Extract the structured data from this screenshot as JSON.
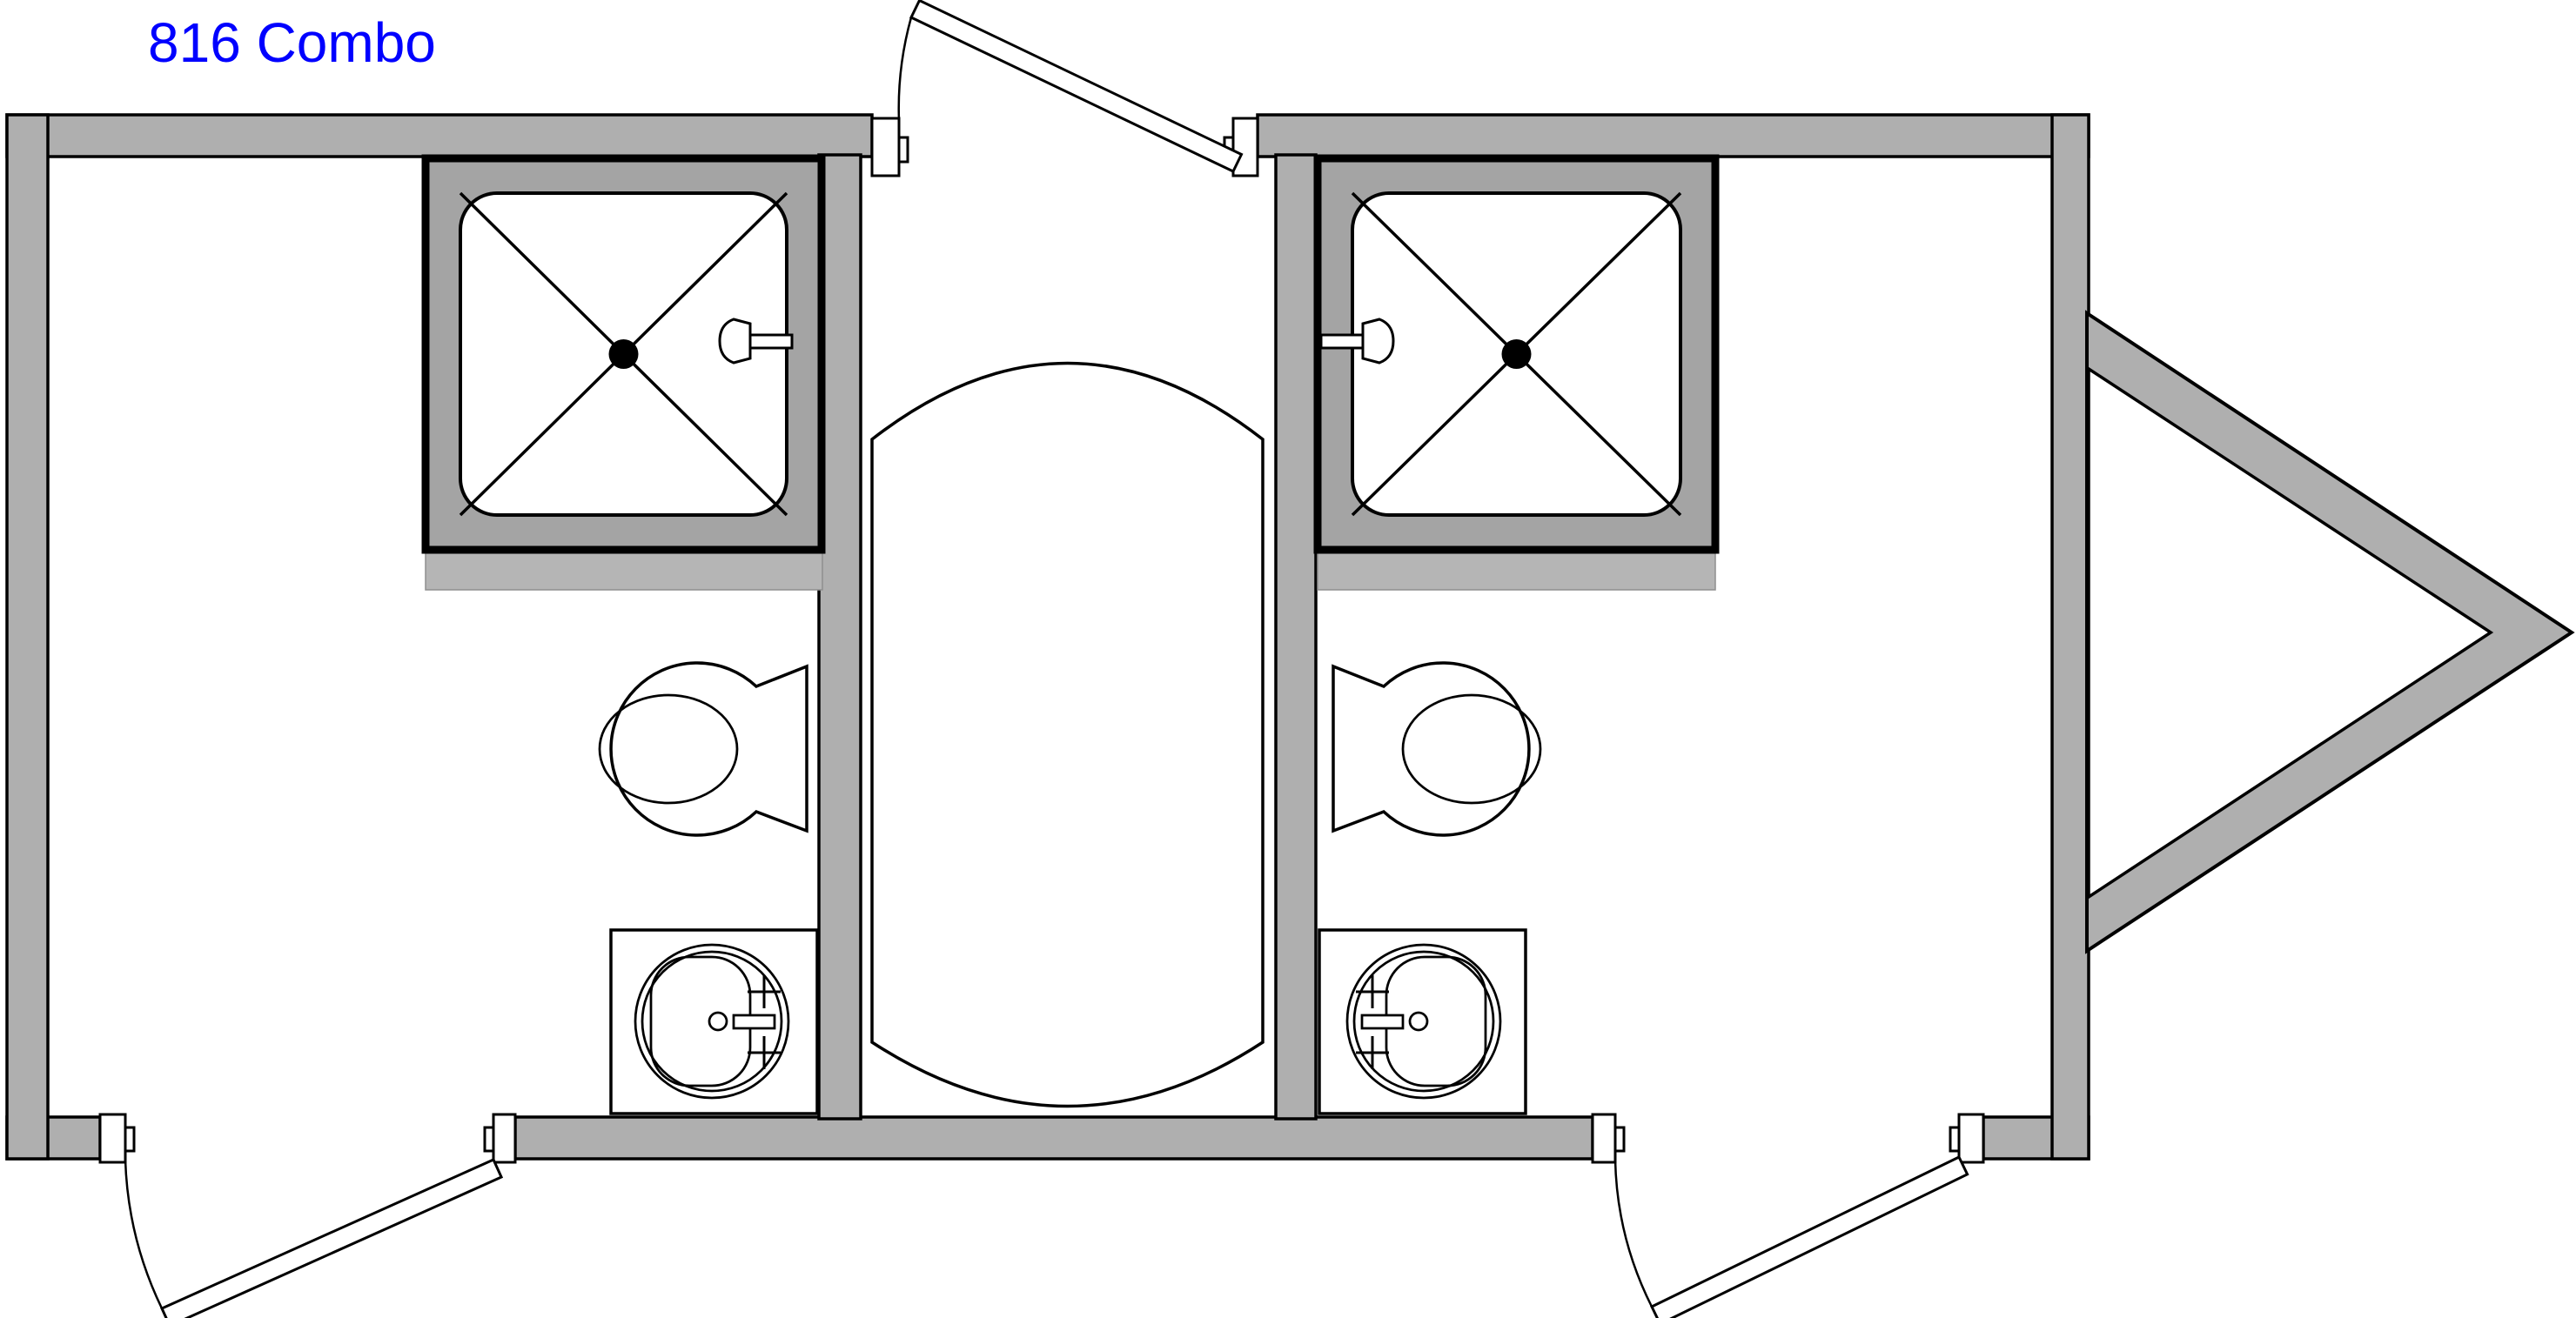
{
  "title": {
    "text": "816 Combo"
  },
  "colors": {
    "title": "#0000FF",
    "wall": "#AFAFAF",
    "stall-pad": "#A4A4A4",
    "platform": "#B5B5B5",
    "outline": "#000000"
  },
  "plan": {
    "unit_name": "816 Combo",
    "type": "restroom-trailer-floor-plan",
    "left_room": {
      "fixtures": [
        "shower-stall",
        "toilet",
        "sink"
      ]
    },
    "right_room": {
      "fixtures": [
        "shower-stall",
        "toilet",
        "sink"
      ]
    },
    "center_bay": {
      "fixtures": [
        "water-tank"
      ],
      "door": "top-center"
    },
    "doors": {
      "top_center": 1,
      "bottom_left": 1,
      "bottom_right": 1
    },
    "hitch_side": "right"
  }
}
